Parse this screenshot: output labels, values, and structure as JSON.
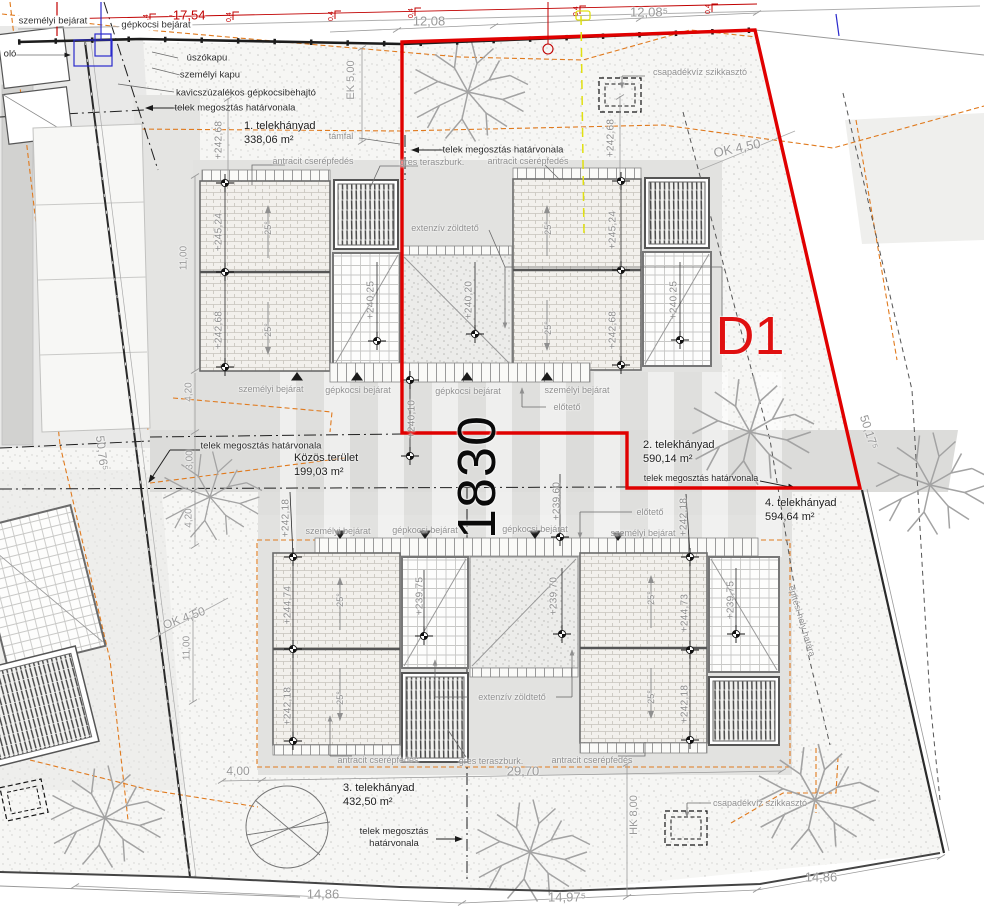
{
  "parcel": {
    "number": "1830",
    "unit": "D1"
  },
  "plots": {
    "p1": {
      "title": "1. telekhányad",
      "area": "338,06 m²"
    },
    "p2": {
      "title": "2. telekhányad",
      "area": "590,14 m²"
    },
    "p3": {
      "title": "3. telekhányad",
      "area": "432,50 m²"
    },
    "p4": {
      "title": "4. telekhányad",
      "area": "594,64 m²"
    },
    "common": {
      "title": "Közös terület",
      "area": "199,03 m²"
    }
  },
  "lines": {
    "division": "telek megosztás határvonala",
    "build_limit": "építési hely határa"
  },
  "entrances": {
    "personal": "személyi bejárat",
    "car": "gépkocsi bejárat",
    "floating_gate": "úszókapu",
    "personal_gate": "személyi kapu",
    "gravel_drive": "kavicszúzalékos gépkocsibehajtó",
    "storage_partial": "oló"
  },
  "features": {
    "retaining_wall": "támfal",
    "tile_roof": "antracit cserépfedés",
    "terrace": "gres teraszburk.",
    "green_roof": "extenzív zöldtető",
    "canopy": "előtető",
    "soakaway": "csapadékvíz szikkasztó",
    "slope": "25°"
  },
  "elevations": {
    "e24524": "+245,24",
    "e24268": "+242,68",
    "e24025": "+240,25",
    "e24020": "+240,20",
    "e24010": "+240,10",
    "e23960": "+239,60",
    "e24474": "+244,74",
    "e24473": "+244,73",
    "e24218": "+242,18",
    "e23975": "+239,75",
    "e23970": "+239,70"
  },
  "dimensions": {
    "d1754": "-17,54",
    "d1208": "12,08",
    "d12085": "12,08⁵",
    "ek500": "EK 5,00",
    "ok450": "OK 4,50",
    "hk800": "HK 8,00",
    "d1100": "11,00",
    "d420": "4,20",
    "d300": "3,00",
    "d400": "4,00",
    "d2970": "29,70",
    "d1486": "14,86",
    "d14975": "14,97⁵",
    "d50765": "50,76⁵",
    "d50175": "50,17⁵",
    "d04": "0,4"
  },
  "colors": {
    "boundary_red": "#e00000",
    "unit_red": "#e01010",
    "contour_orange": "#e07a1e",
    "marker_yellow": "#e0e010",
    "marker_blue": "#2a2acc",
    "dim_red": "#c00000"
  }
}
